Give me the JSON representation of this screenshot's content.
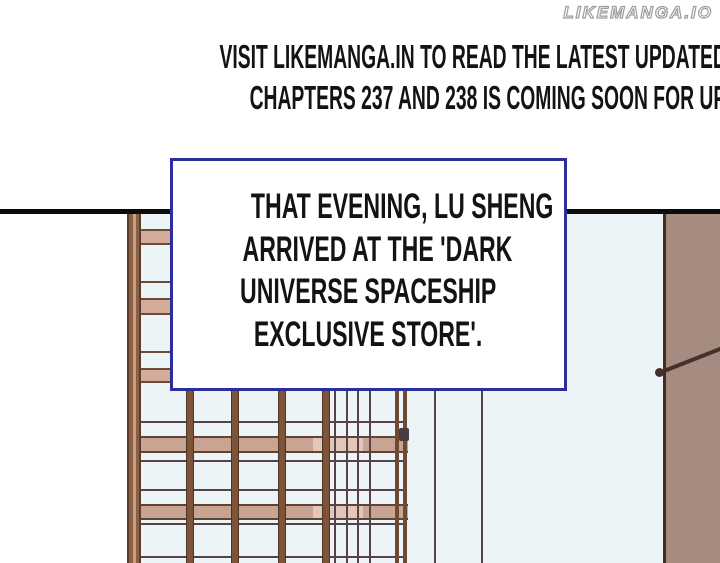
{
  "watermark": {
    "text": "LIKEMANGA.IO"
  },
  "header": {
    "line1": "VISIT LIKEMANGA.IN TO READ THE LATEST UPDATED CHAPTERS",
    "line2": "CHAPTERS 237 AND 238 IS COMING SOON FOR UPDATE AT LIKEMANGA.IN",
    "text_color": "#131313"
  },
  "caption_box": {
    "lines": [
      "THAT EVENING, LU SHENG",
      "ARRIVED AT THE 'DARK",
      "UNIVERSE SPACESHIP",
      "EXCLUSIVE STORE'."
    ],
    "border_color": "#2b2f9e",
    "text_color": "#131313",
    "background": "#ffffff"
  },
  "artwork": {
    "panel_line_color": "#0b0b0b",
    "facade_background": "#edf4f8",
    "wall_color": "#a68b80",
    "wall_edge_color": "#3f2d24",
    "beam_color": "#7d543a",
    "thin_line_color": "#564349",
    "band_fill_color": "#c9a492",
    "band_light_color": "#e2c6ba",
    "ladder_brown": "#8a5f43",
    "rung_fill_color": "#d4ac9c",
    "watermark_outline_color": "#9e9e9e"
  }
}
